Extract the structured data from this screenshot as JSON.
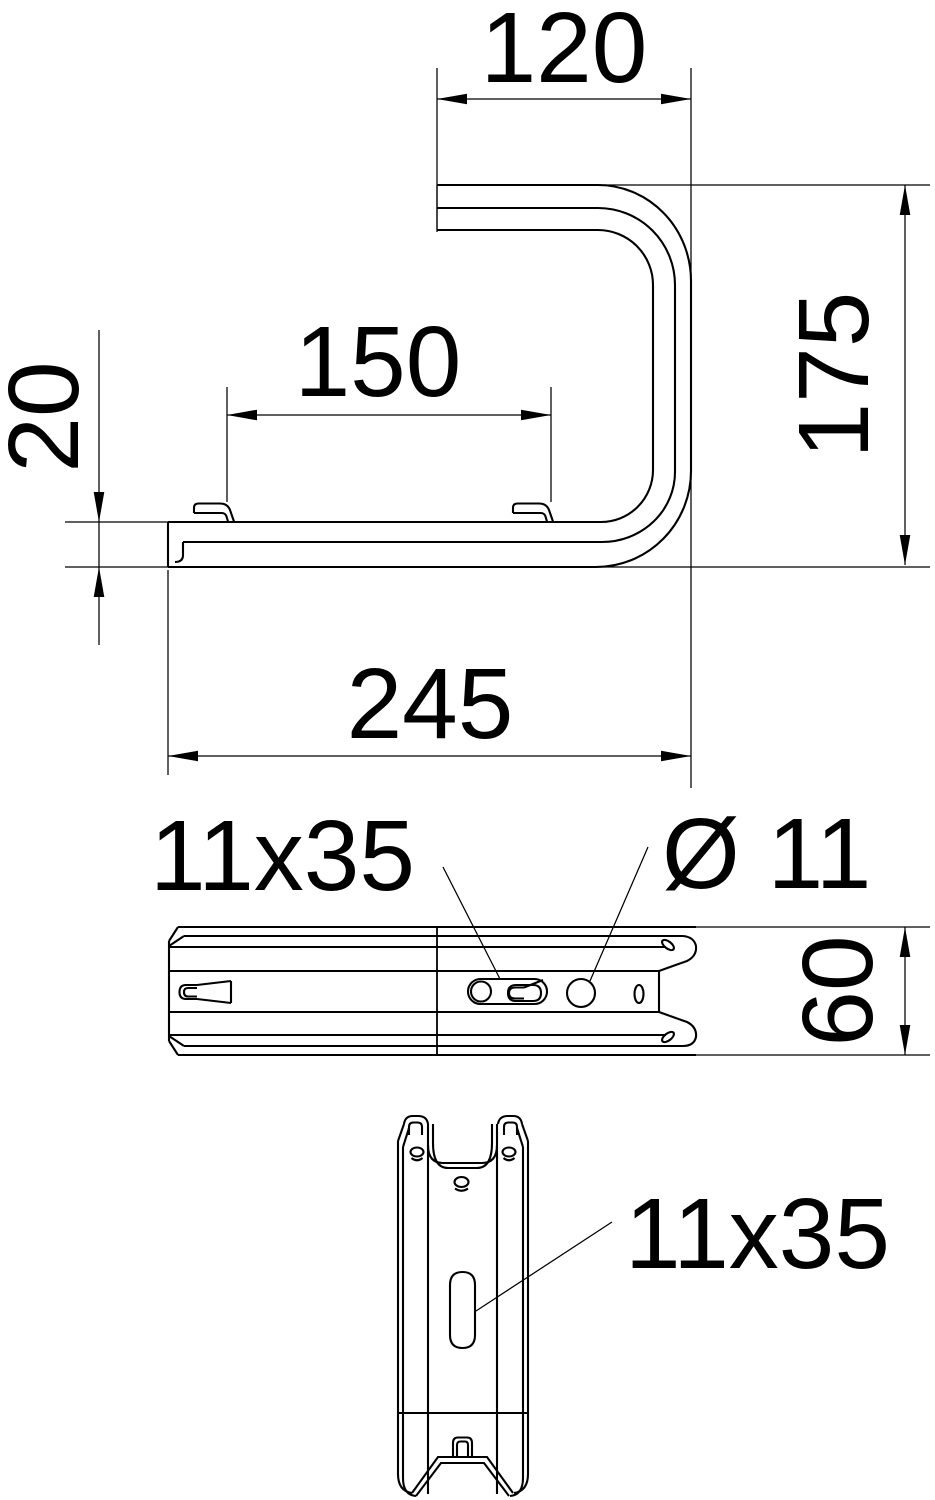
{
  "drawing_title": "bracket-technical-drawing",
  "colors": {
    "line": "#000000",
    "background": "#ffffff"
  },
  "views": {
    "side": {
      "label": "side-profile-view"
    },
    "plan": {
      "label": "rail-top-view"
    },
    "front": {
      "label": "bracket-front-view"
    }
  },
  "dimensions": {
    "top_width": "120",
    "height": "175",
    "inner_width": "150",
    "profile_depth": "20",
    "total_depth": "245",
    "rail_width": "60",
    "slot_plan": "11x35",
    "hole_plan": "Ø 11",
    "slot_front": "11x35"
  }
}
